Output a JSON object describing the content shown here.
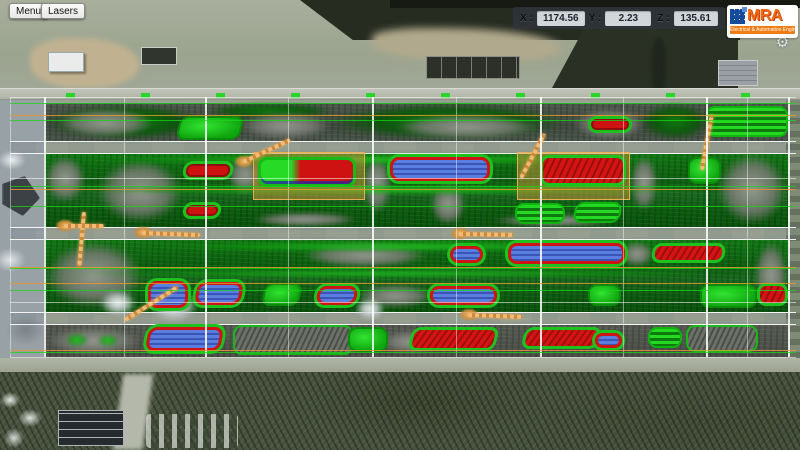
{
  "toolbar": {
    "menu_label": "Menu",
    "lasers_label": "Lasers"
  },
  "coords": {
    "x_label": "X :",
    "x_value": "1174.56",
    "y_label": "Y :",
    "y_value": "2.23",
    "z_label": "Z :",
    "z_value": "135.61"
  },
  "logo": {
    "brand": "MRA",
    "tagline": "Electrical & Automation Engineering",
    "brand_color": "#f26a10",
    "tile_color": "#164a9c",
    "gear_icon": "⚙"
  },
  "colors": {
    "pointcloud_green": "#14b814",
    "pointcloud_gray": "#8d918a",
    "pile_red": "#ce1111",
    "pile_blue": "#4a6fd6",
    "crane_orange": "#e8a35c",
    "selection_tan": "#d0943a",
    "road_gray": "#c6d0dc",
    "grid_white": "#ffffff",
    "line_green": "#19d719",
    "line_orange": "#e4982d"
  },
  "yard": {
    "grid": {
      "v_top": 97,
      "v_bottom": 357,
      "h_left": 10,
      "h_right": 796,
      "v_major": [
        44,
        205,
        372,
        540,
        706,
        788
      ],
      "v_minor": [
        10,
        124,
        288,
        456,
        623,
        747
      ],
      "h_green": [
        103,
        120,
        186,
        206,
        268,
        290,
        352
      ],
      "h_orange": [
        115,
        189,
        267,
        283,
        350
      ],
      "h_white": [
        97,
        178,
        302,
        357
      ]
    },
    "rows": [
      {
        "k": "a",
        "y": 103,
        "h": 38
      },
      {
        "k": "b",
        "y": 154,
        "h": 73
      },
      {
        "k": "c",
        "y": 240,
        "h": 72
      },
      {
        "k": "d",
        "y": 325,
        "h": 32
      }
    ],
    "roads": [
      {
        "y": 141,
        "h": 13
      },
      {
        "y": 227,
        "h": 13
      },
      {
        "y": 312,
        "h": 13
      }
    ],
    "highlights": [
      {
        "x": 253,
        "y": 152,
        "w": 112,
        "h": 48
      },
      {
        "x": 517,
        "y": 152,
        "w": 113,
        "h": 48
      }
    ],
    "blobs": [
      {
        "x": 46,
        "y": 104,
        "w": 160,
        "h": 36,
        "c": "dgreen"
      },
      {
        "x": 55,
        "y": 108,
        "w": 100,
        "h": 30,
        "c": "gray"
      },
      {
        "x": 205,
        "y": 103,
        "w": 130,
        "h": 16,
        "c": "dgreen"
      },
      {
        "x": 238,
        "y": 112,
        "w": 95,
        "h": 28,
        "c": "gray"
      },
      {
        "x": 330,
        "y": 103,
        "w": 235,
        "h": 37,
        "c": "dgreen"
      },
      {
        "x": 392,
        "y": 114,
        "w": 150,
        "h": 26,
        "c": "gray"
      },
      {
        "x": 572,
        "y": 108,
        "w": 75,
        "h": 32,
        "c": "gray"
      },
      {
        "x": 640,
        "y": 103,
        "w": 70,
        "h": 37,
        "c": "dgreen"
      },
      {
        "x": 44,
        "y": 155,
        "w": 42,
        "h": 48,
        "c": "gray"
      },
      {
        "x": 96,
        "y": 158,
        "w": 88,
        "h": 66,
        "c": "gray"
      },
      {
        "x": 228,
        "y": 154,
        "w": 34,
        "h": 42,
        "c": "gray"
      },
      {
        "x": 362,
        "y": 154,
        "w": 30,
        "h": 60,
        "c": "gray"
      },
      {
        "x": 430,
        "y": 182,
        "w": 36,
        "h": 44,
        "c": "gray"
      },
      {
        "x": 630,
        "y": 154,
        "w": 28,
        "h": 58,
        "c": "gray"
      },
      {
        "x": 716,
        "y": 152,
        "w": 72,
        "h": 74,
        "c": "gray"
      },
      {
        "x": 60,
        "y": 155,
        "w": 620,
        "h": 9,
        "c": "green"
      },
      {
        "x": 60,
        "y": 186,
        "w": 660,
        "h": 8,
        "c": "green"
      },
      {
        "x": 250,
        "y": 212,
        "w": 110,
        "h": 15,
        "c": "gray"
      },
      {
        "x": 490,
        "y": 214,
        "w": 130,
        "h": 13,
        "c": "gray"
      },
      {
        "x": 44,
        "y": 240,
        "w": 100,
        "h": 70,
        "c": "gray"
      },
      {
        "x": 300,
        "y": 242,
        "w": 130,
        "h": 26,
        "c": "gray"
      },
      {
        "x": 620,
        "y": 241,
        "w": 34,
        "h": 26,
        "c": "gray"
      },
      {
        "x": 754,
        "y": 240,
        "w": 34,
        "h": 70,
        "c": "gray"
      },
      {
        "x": 150,
        "y": 242,
        "w": 500,
        "h": 9,
        "c": "green"
      },
      {
        "x": 60,
        "y": 270,
        "w": 680,
        "h": 7,
        "c": "green"
      },
      {
        "x": 355,
        "y": 284,
        "w": 80,
        "h": 24,
        "c": "gray"
      },
      {
        "x": 150,
        "y": 288,
        "w": 48,
        "h": 34,
        "c": "white"
      },
      {
        "x": 100,
        "y": 290,
        "w": 36,
        "h": 26,
        "c": "white"
      },
      {
        "x": 355,
        "y": 298,
        "w": 30,
        "h": 22,
        "c": "white"
      },
      {
        "x": 44,
        "y": 326,
        "w": 100,
        "h": 30,
        "c": "gray"
      },
      {
        "x": 380,
        "y": 330,
        "w": 60,
        "h": 24,
        "c": "gray"
      },
      {
        "x": 66,
        "y": 334,
        "w": 22,
        "h": 12,
        "c": "green"
      },
      {
        "x": 98,
        "y": 335,
        "w": 20,
        "h": 11,
        "c": "green"
      }
    ],
    "piles": [
      {
        "x": 178,
        "y": 116,
        "w": 64,
        "h": 24,
        "t": "green",
        "sk": -14
      },
      {
        "x": 588,
        "y": 116,
        "w": 44,
        "h": 17,
        "t": "red"
      },
      {
        "x": 706,
        "y": 106,
        "w": 82,
        "h": 31,
        "t": "greenstripe"
      },
      {
        "x": 183,
        "y": 161,
        "w": 50,
        "h": 19,
        "t": "red",
        "sk": -8
      },
      {
        "x": 258,
        "y": 157,
        "w": 98,
        "h": 30,
        "t": "combo"
      },
      {
        "x": 390,
        "y": 157,
        "w": 100,
        "h": 24,
        "t": "blue"
      },
      {
        "x": 540,
        "y": 155,
        "w": 86,
        "h": 31,
        "t": "redhatch"
      },
      {
        "x": 688,
        "y": 157,
        "w": 33,
        "h": 27,
        "t": "green"
      },
      {
        "x": 183,
        "y": 202,
        "w": 38,
        "h": 17,
        "t": "red",
        "sk": -8
      },
      {
        "x": 515,
        "y": 203,
        "w": 50,
        "h": 21,
        "t": "greenstripe"
      },
      {
        "x": 574,
        "y": 202,
        "w": 47,
        "h": 21,
        "t": "greenstripe",
        "sk": -10
      },
      {
        "x": 450,
        "y": 246,
        "w": 33,
        "h": 17,
        "t": "blue"
      },
      {
        "x": 508,
        "y": 243,
        "w": 117,
        "h": 21,
        "t": "blue"
      },
      {
        "x": 652,
        "y": 243,
        "w": 73,
        "h": 20,
        "t": "redhatch",
        "sk": -8
      },
      {
        "x": 148,
        "y": 281,
        "w": 40,
        "h": 27,
        "t": "blue"
      },
      {
        "x": 196,
        "y": 282,
        "w": 46,
        "h": 23,
        "t": "blue",
        "sk": -10
      },
      {
        "x": 263,
        "y": 283,
        "w": 38,
        "h": 23,
        "t": "green",
        "sk": -12
      },
      {
        "x": 317,
        "y": 286,
        "w": 40,
        "h": 19,
        "t": "blue",
        "sk": -8
      },
      {
        "x": 430,
        "y": 286,
        "w": 67,
        "h": 19,
        "t": "blue"
      },
      {
        "x": 588,
        "y": 284,
        "w": 33,
        "h": 22,
        "t": "green"
      },
      {
        "x": 700,
        "y": 284,
        "w": 57,
        "h": 24,
        "t": "green"
      },
      {
        "x": 757,
        "y": 283,
        "w": 31,
        "h": 23,
        "t": "redhatch"
      },
      {
        "x": 147,
        "y": 327,
        "w": 75,
        "h": 24,
        "t": "blue",
        "sk": -10
      },
      {
        "x": 233,
        "y": 325,
        "w": 120,
        "h": 30,
        "t": "grayhatch"
      },
      {
        "x": 348,
        "y": 327,
        "w": 40,
        "h": 25,
        "t": "green"
      },
      {
        "x": 410,
        "y": 327,
        "w": 87,
        "h": 24,
        "t": "redhatch",
        "sk": -14
      },
      {
        "x": 523,
        "y": 327,
        "w": 77,
        "h": 22,
        "t": "redhatch",
        "sk": -14
      },
      {
        "x": 595,
        "y": 333,
        "w": 27,
        "h": 15,
        "t": "blue"
      },
      {
        "x": 648,
        "y": 327,
        "w": 34,
        "h": 21,
        "t": "greenstripe"
      },
      {
        "x": 686,
        "y": 325,
        "w": 72,
        "h": 27,
        "t": "grayhatch"
      }
    ],
    "cranes": [
      {
        "x": 84,
        "y": 210,
        "len": 55,
        "rot": 95,
        "cluster": false
      },
      {
        "x": 64,
        "y": 224,
        "len": 40,
        "rot": 0,
        "cluster": true
      },
      {
        "x": 125,
        "y": 318,
        "len": 62,
        "rot": -32,
        "cluster": false
      },
      {
        "x": 142,
        "y": 231,
        "len": 58,
        "rot": 2,
        "cluster": true
      },
      {
        "x": 459,
        "y": 232,
        "len": 54,
        "rot": 1,
        "cluster": true
      },
      {
        "x": 468,
        "y": 313,
        "len": 54,
        "rot": 2,
        "cluster": true
      },
      {
        "x": 521,
        "y": 176,
        "len": 50,
        "rot": -62,
        "cluster": false
      },
      {
        "x": 702,
        "y": 168,
        "len": 56,
        "rot": -80,
        "cluster": false
      },
      {
        "x": 243,
        "y": 160,
        "len": 52,
        "rot": -25,
        "cluster": true
      }
    ]
  }
}
